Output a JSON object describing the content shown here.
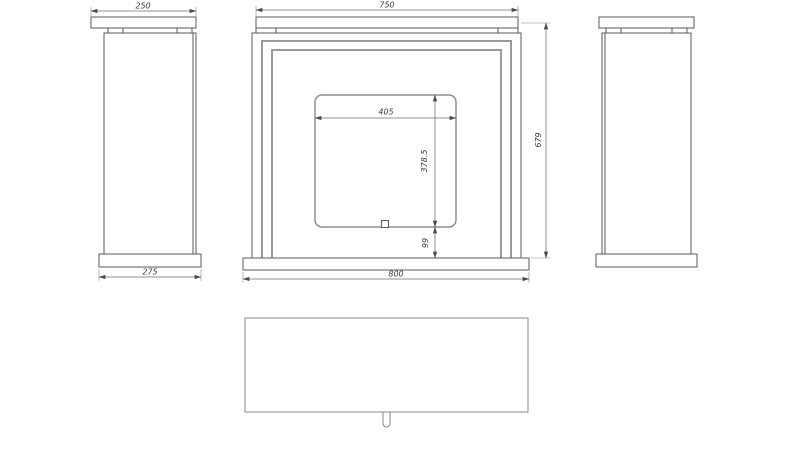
{
  "drawing": {
    "dimensions": {
      "top_shelf_width": "750",
      "base_width": "800",
      "overall_height": "679",
      "opening_width": "405",
      "opening_height": "378.5",
      "opening_base_offset": "99",
      "column_top_depth": "250",
      "column_base_depth": "275"
    },
    "colors": {
      "background": "#ffffff",
      "object_line": "#5a5a5a",
      "frame_line": "#9a9a9a",
      "dimension_line": "#6e6e6e",
      "text": "#3c3c3c"
    }
  }
}
